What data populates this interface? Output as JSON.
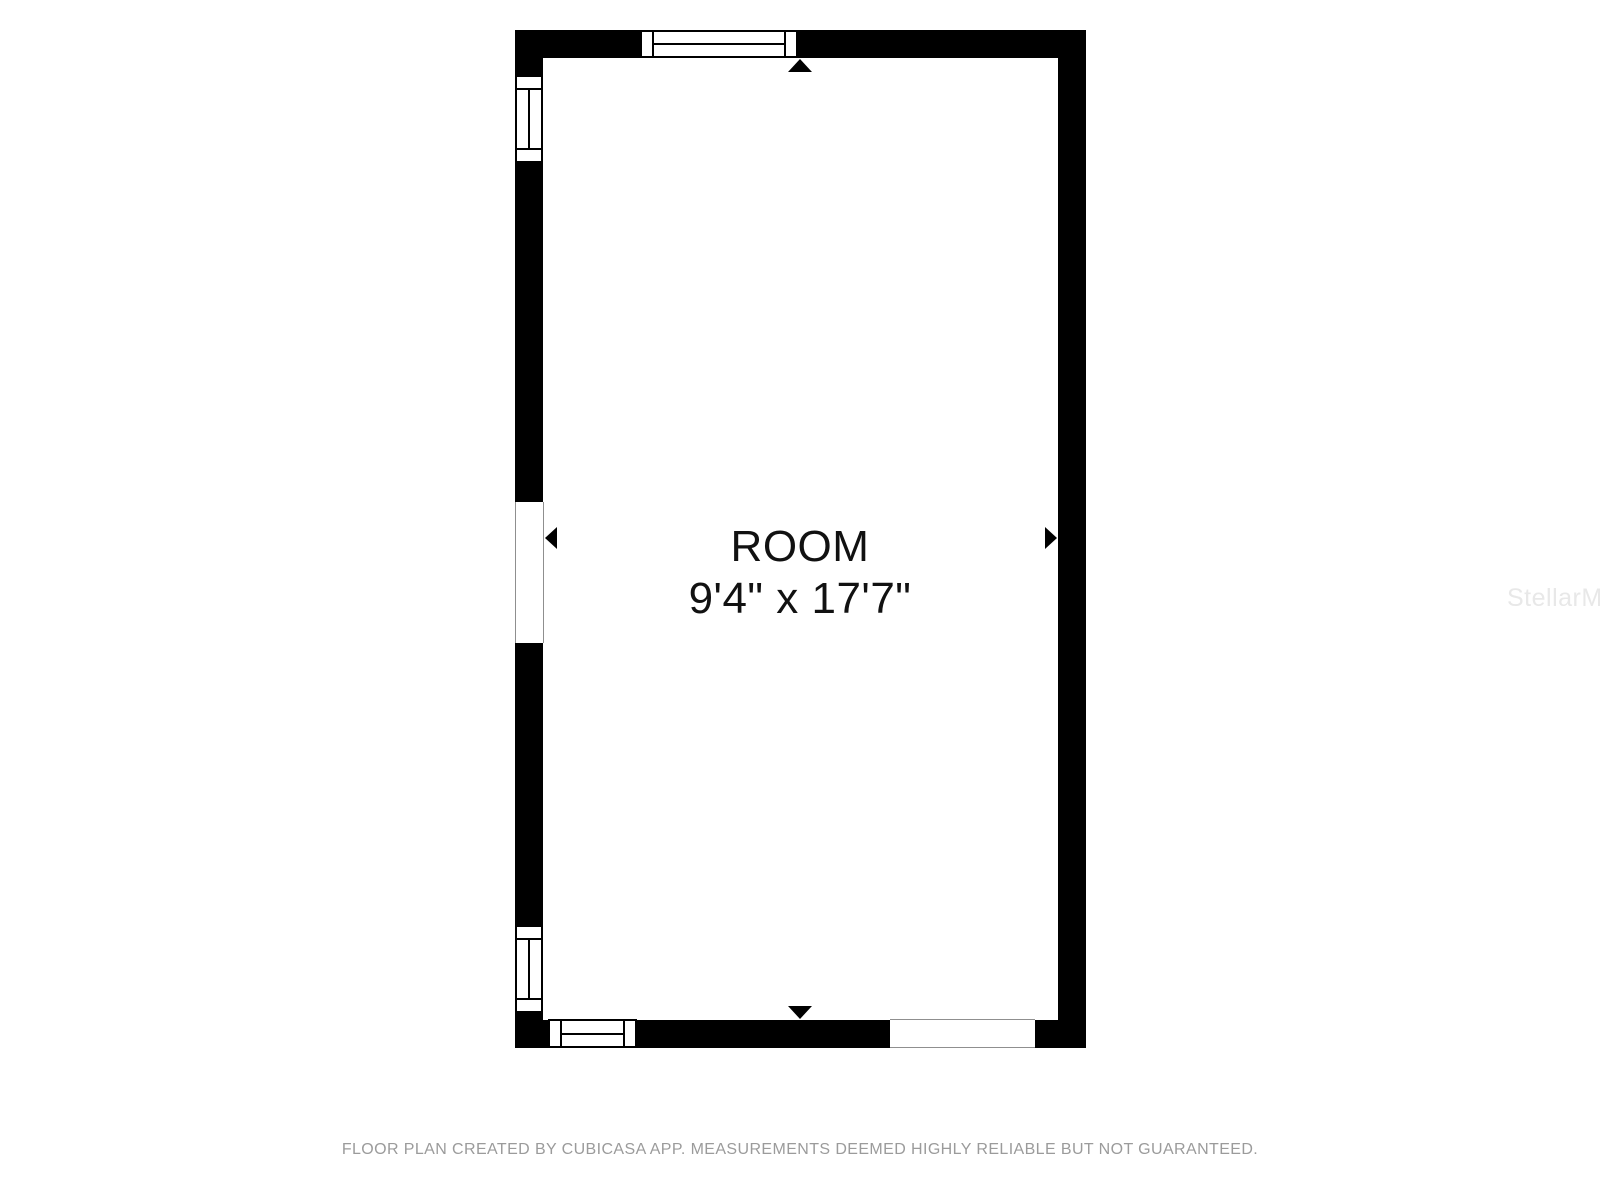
{
  "floor_plan": {
    "room": {
      "name": "ROOM",
      "dimensions": "9'4\" x 17'7\""
    },
    "wall_color": "#000000",
    "text_color": "#111111",
    "windows": [
      {
        "name": "top-wall-window"
      },
      {
        "name": "left-wall-upper-window"
      },
      {
        "name": "left-wall-lower-window"
      },
      {
        "name": "bottom-wall-window"
      }
    ],
    "openings": [
      {
        "name": "left-wall-door-opening"
      },
      {
        "name": "bottom-wall-opening"
      }
    ],
    "dimension_arrows": [
      {
        "name": "arrow-up-icon"
      },
      {
        "name": "arrow-down-icon"
      },
      {
        "name": "arrow-left-icon"
      },
      {
        "name": "arrow-right-icon"
      }
    ]
  },
  "watermark": {
    "text": "StellarMLS",
    "color": "#e8e8e8"
  },
  "footer": {
    "disclaimer": "FLOOR PLAN CREATED BY CUBICASA APP. MEASUREMENTS DEEMED HIGHLY RELIABLE BUT NOT GUARANTEED.",
    "color": "#9b9b9b"
  }
}
